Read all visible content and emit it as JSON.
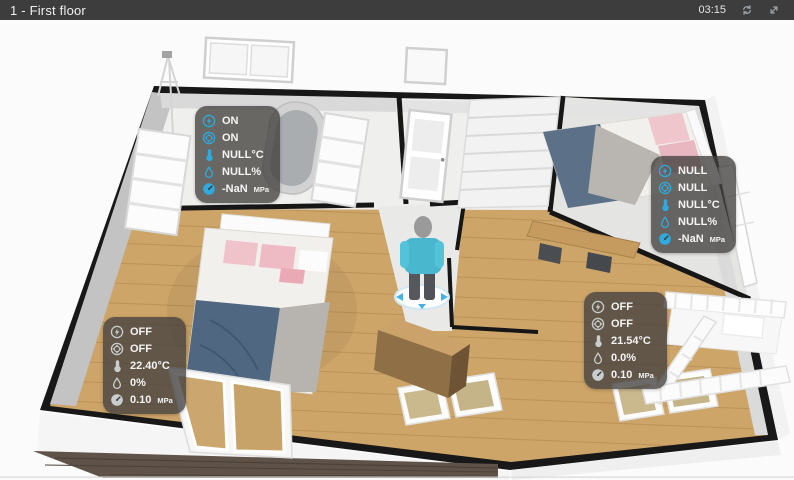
{
  "header": {
    "title": "1 - First floor",
    "time": "03:15"
  },
  "colors": {
    "titlebar_bg": "#3d3d3d",
    "accent_blue": "#30a9dc",
    "icon_off": "#c9cdce",
    "panel_bg": "rgba(66,64,62,0.78)",
    "wood_floor": "#cda569"
  },
  "panels": [
    {
      "name": "bathroom-sensors",
      "state": "on",
      "rows": [
        {
          "icon": "power-icon",
          "text": "ON",
          "unit": ""
        },
        {
          "icon": "valve-icon",
          "text": "ON",
          "unit": ""
        },
        {
          "icon": "temperature-icon",
          "text": "NULL°C",
          "unit": ""
        },
        {
          "icon": "humidity-icon",
          "text": "NULL%",
          "unit": ""
        },
        {
          "icon": "pressure-icon",
          "text": "-NaN",
          "unit": "MPa"
        }
      ]
    },
    {
      "name": "bedroom-right-sensors",
      "state": "on",
      "rows": [
        {
          "icon": "power-icon",
          "text": "NULL",
          "unit": ""
        },
        {
          "icon": "valve-icon",
          "text": "NULL",
          "unit": ""
        },
        {
          "icon": "temperature-icon",
          "text": "NULL°C",
          "unit": ""
        },
        {
          "icon": "humidity-icon",
          "text": "NULL%",
          "unit": ""
        },
        {
          "icon": "pressure-icon",
          "text": "-NaN",
          "unit": "MPa"
        }
      ]
    },
    {
      "name": "master-bedroom-sensors",
      "state": "off",
      "rows": [
        {
          "icon": "power-icon",
          "text": "OFF",
          "unit": ""
        },
        {
          "icon": "valve-icon",
          "text": "OFF",
          "unit": ""
        },
        {
          "icon": "temperature-icon",
          "text": "22.40°C",
          "unit": ""
        },
        {
          "icon": "humidity-icon",
          "text": "0%",
          "unit": ""
        },
        {
          "icon": "pressure-icon",
          "text": "0.10",
          "unit": "MPa"
        }
      ]
    },
    {
      "name": "kids-room-sensors",
      "state": "off",
      "rows": [
        {
          "icon": "power-icon",
          "text": "OFF",
          "unit": ""
        },
        {
          "icon": "valve-icon",
          "text": "OFF",
          "unit": ""
        },
        {
          "icon": "temperature-icon",
          "text": "21.54°C",
          "unit": ""
        },
        {
          "icon": "humidity-icon",
          "text": "0.0%",
          "unit": ""
        },
        {
          "icon": "pressure-icon",
          "text": "0.10",
          "unit": "MPa"
        }
      ]
    }
  ]
}
